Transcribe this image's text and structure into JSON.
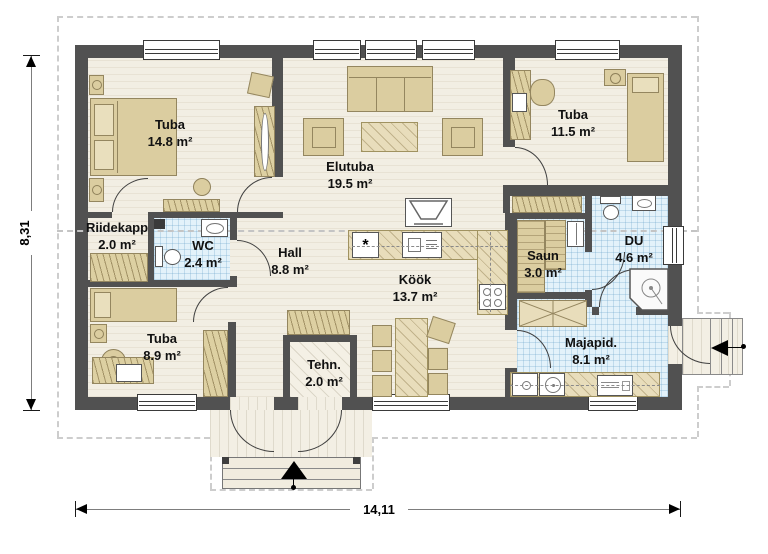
{
  "plan": {
    "dimensions": {
      "width": "14,11",
      "height": "8,31"
    },
    "rooms": [
      {
        "name": "Tuba",
        "area": "14.8 m²"
      },
      {
        "name": "Elutuba",
        "area": "19.5 m²"
      },
      {
        "name": "Tuba",
        "area": "11.5 m²"
      },
      {
        "name": "Riidekapp",
        "area": "2.0 m²"
      },
      {
        "name": "WC",
        "area": "2.4 m²"
      },
      {
        "name": "Hall",
        "area": "8.8 m²"
      },
      {
        "name": "Köök",
        "area": "13.7 m²"
      },
      {
        "name": "Saun",
        "area": "3.0 m²"
      },
      {
        "name": "DU",
        "area": "4.6 m²"
      },
      {
        "name": "Tuba",
        "area": "8.9 m²"
      },
      {
        "name": "Tehn.",
        "area": "2.0 m²"
      },
      {
        "name": "Majapid.",
        "area": "8.1 m²"
      }
    ],
    "symbols": {
      "freezer_star": "*"
    },
    "colors": {
      "wall": "#515151",
      "floor": "#f2eee3",
      "tile": "#e3f2fa",
      "furniture": "#dbcda0",
      "dashed_outline": "#cdcdcd"
    }
  }
}
